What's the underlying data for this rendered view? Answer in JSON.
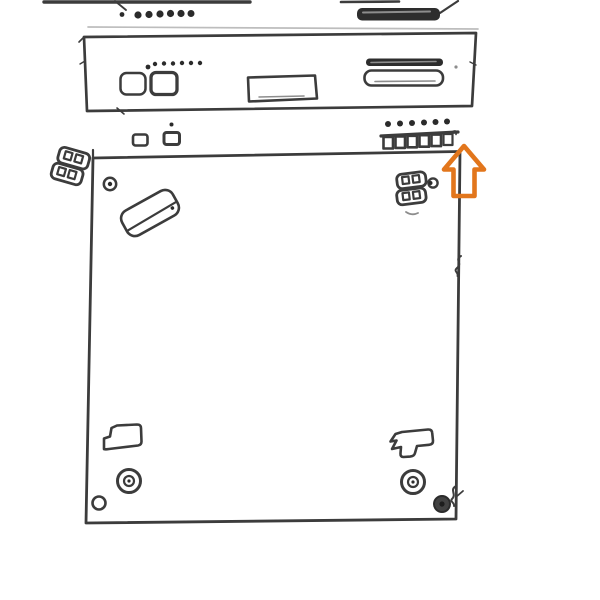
{
  "meta": {
    "kind": "technical-assembly-line-drawing",
    "description_name": "device-exploded-diagram"
  },
  "colors": {
    "background": "#ffffff",
    "line": "#3c3c3c",
    "ink": "#2b2b2b",
    "line_light": "#8d8d8d",
    "line_faint": "#bdbdbd",
    "slot_fill": "#2d2d2d",
    "accent": "#e2761c"
  },
  "diagram": {
    "units": [
      {
        "name": "top-unit-partial",
        "features": [
          "dot-row",
          "dark-media-slot",
          "perspective-edges"
        ]
      },
      {
        "name": "front-panel",
        "features": [
          "button-left",
          "button-right",
          "led-dot-row",
          "display-window",
          "slot-bar",
          "slot-opening"
        ]
      },
      {
        "name": "chassis-plate",
        "features": [
          "tilted-bracket",
          "corner-screw-hole",
          "left-clamp",
          "right-clamp",
          "step-bracket-left",
          "step-bracket-right",
          "screw-head-left",
          "screw-head-right",
          "corner-hole-left",
          "dark-grommet-right"
        ]
      }
    ],
    "dot_counts": {
      "top_unit_row": 7,
      "front_panel_leds": 6,
      "front_panel_single": 1,
      "connector_strip_pins": 6,
      "connector_strip_cells": 6
    },
    "annotation": {
      "shape": "block-arrow-up",
      "target": "connector-strip",
      "color": "#e2761c"
    }
  }
}
